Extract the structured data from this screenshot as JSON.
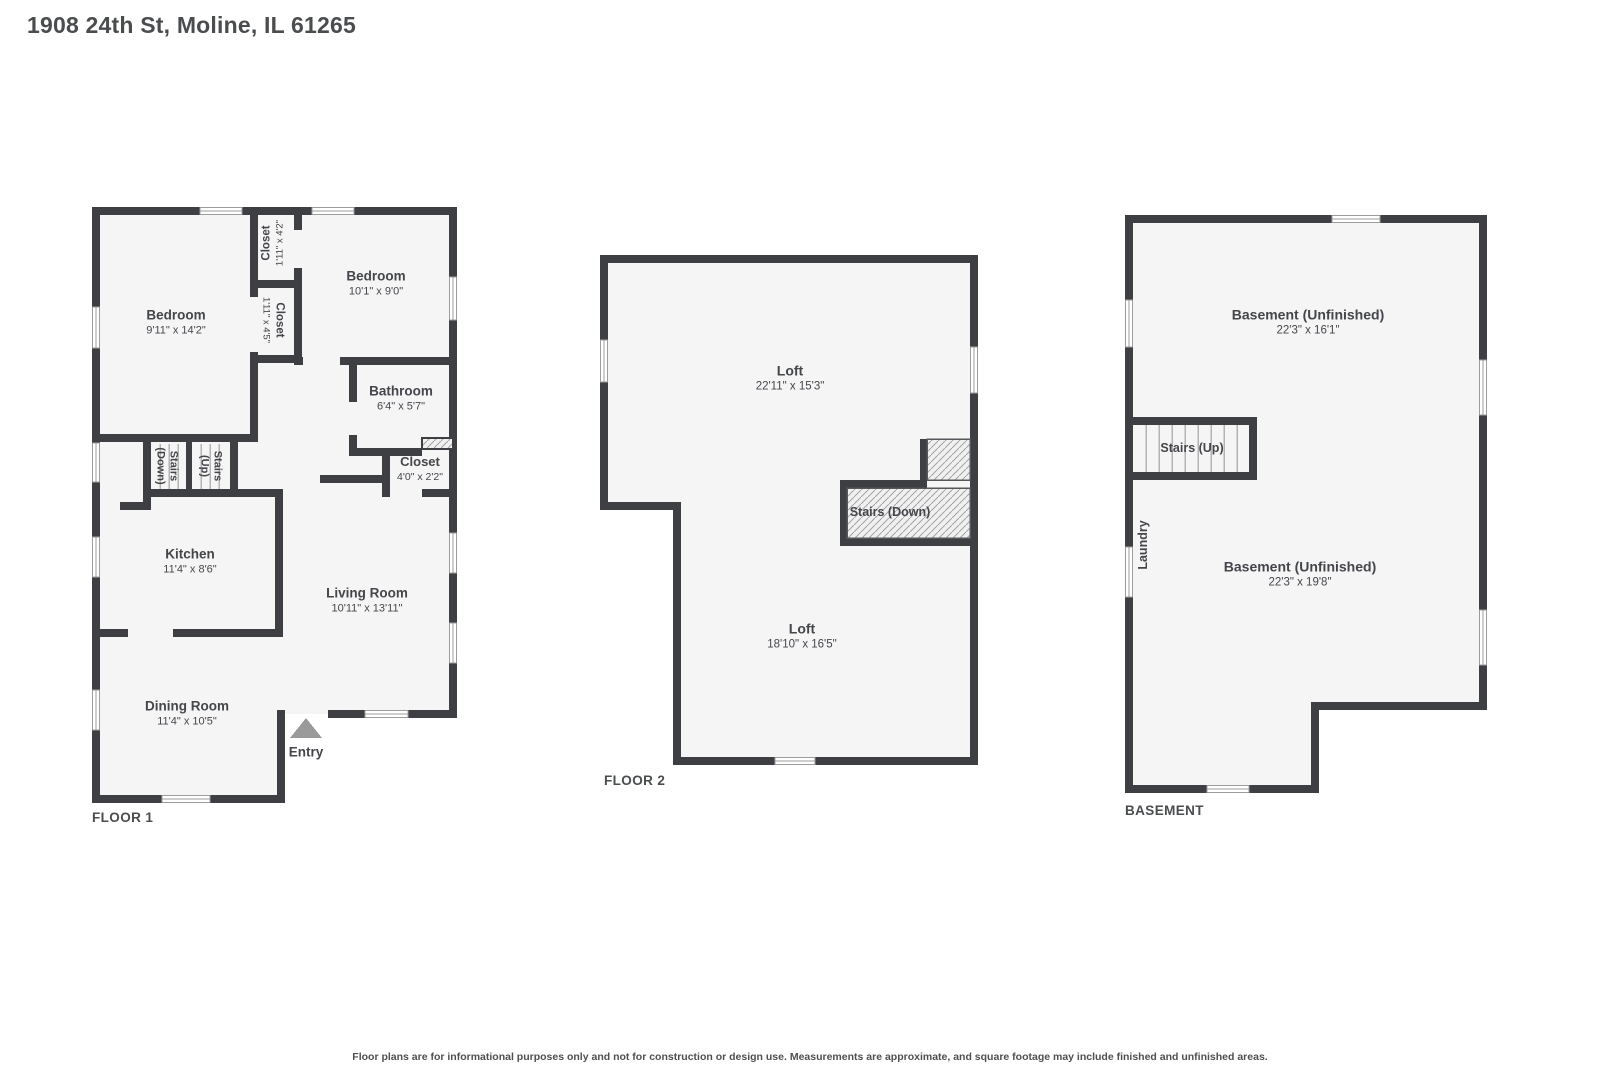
{
  "title": "1908 24th St, Moline, IL 61265",
  "disclaimer": "Floor plans are for informational purposes only and not for construction or design use. Measurements are approximate, and square footage may include finished and unfinished areas.",
  "colors": {
    "wall": "#3d3f42",
    "floor_fill": "#f5f5f6",
    "hatch_line": "#a6a6a6",
    "entry_arrow": "#9a9a9a"
  },
  "floors": [
    {
      "label": "FLOOR 1",
      "rooms": [
        {
          "name": "Bedroom",
          "dims": "9'11\" x 14'2\""
        },
        {
          "name": "Closet",
          "dims": "1'11\" x 4'2\""
        },
        {
          "name": "Closet",
          "dims": "1'11\" x 4'5\""
        },
        {
          "name": "Bedroom",
          "dims": "10'1\" x 9'0\""
        },
        {
          "name": "Bathroom",
          "dims": "6'4\" x 5'7\""
        },
        {
          "name": "Closet",
          "dims": "4'0\" x 2'2\""
        },
        {
          "name": "Stairs (Down)",
          "dims": ""
        },
        {
          "name": "Stairs (Up)",
          "dims": ""
        },
        {
          "name": "Kitchen",
          "dims": "11'4\" x 8'6\""
        },
        {
          "name": "Living Room",
          "dims": "10'11\" x 13'11\""
        },
        {
          "name": "Dining Room",
          "dims": "11'4\" x 10'5\""
        },
        {
          "name": "Entry",
          "dims": ""
        }
      ]
    },
    {
      "label": "FLOOR 2",
      "rooms": [
        {
          "name": "Loft",
          "dims": "22'11\" x 15'3\""
        },
        {
          "name": "Stairs (Down)",
          "dims": ""
        },
        {
          "name": "Loft",
          "dims": "18'10\" x 16'5\""
        }
      ]
    },
    {
      "label": "BASEMENT",
      "rooms": [
        {
          "name": "Basement (Unfinished)",
          "dims": "22'3\" x 16'1\""
        },
        {
          "name": "Stairs (Up)",
          "dims": ""
        },
        {
          "name": "Laundry",
          "dims": ""
        },
        {
          "name": "Basement (Unfinished)",
          "dims": "22'3\" x 19'8\""
        }
      ]
    }
  ]
}
